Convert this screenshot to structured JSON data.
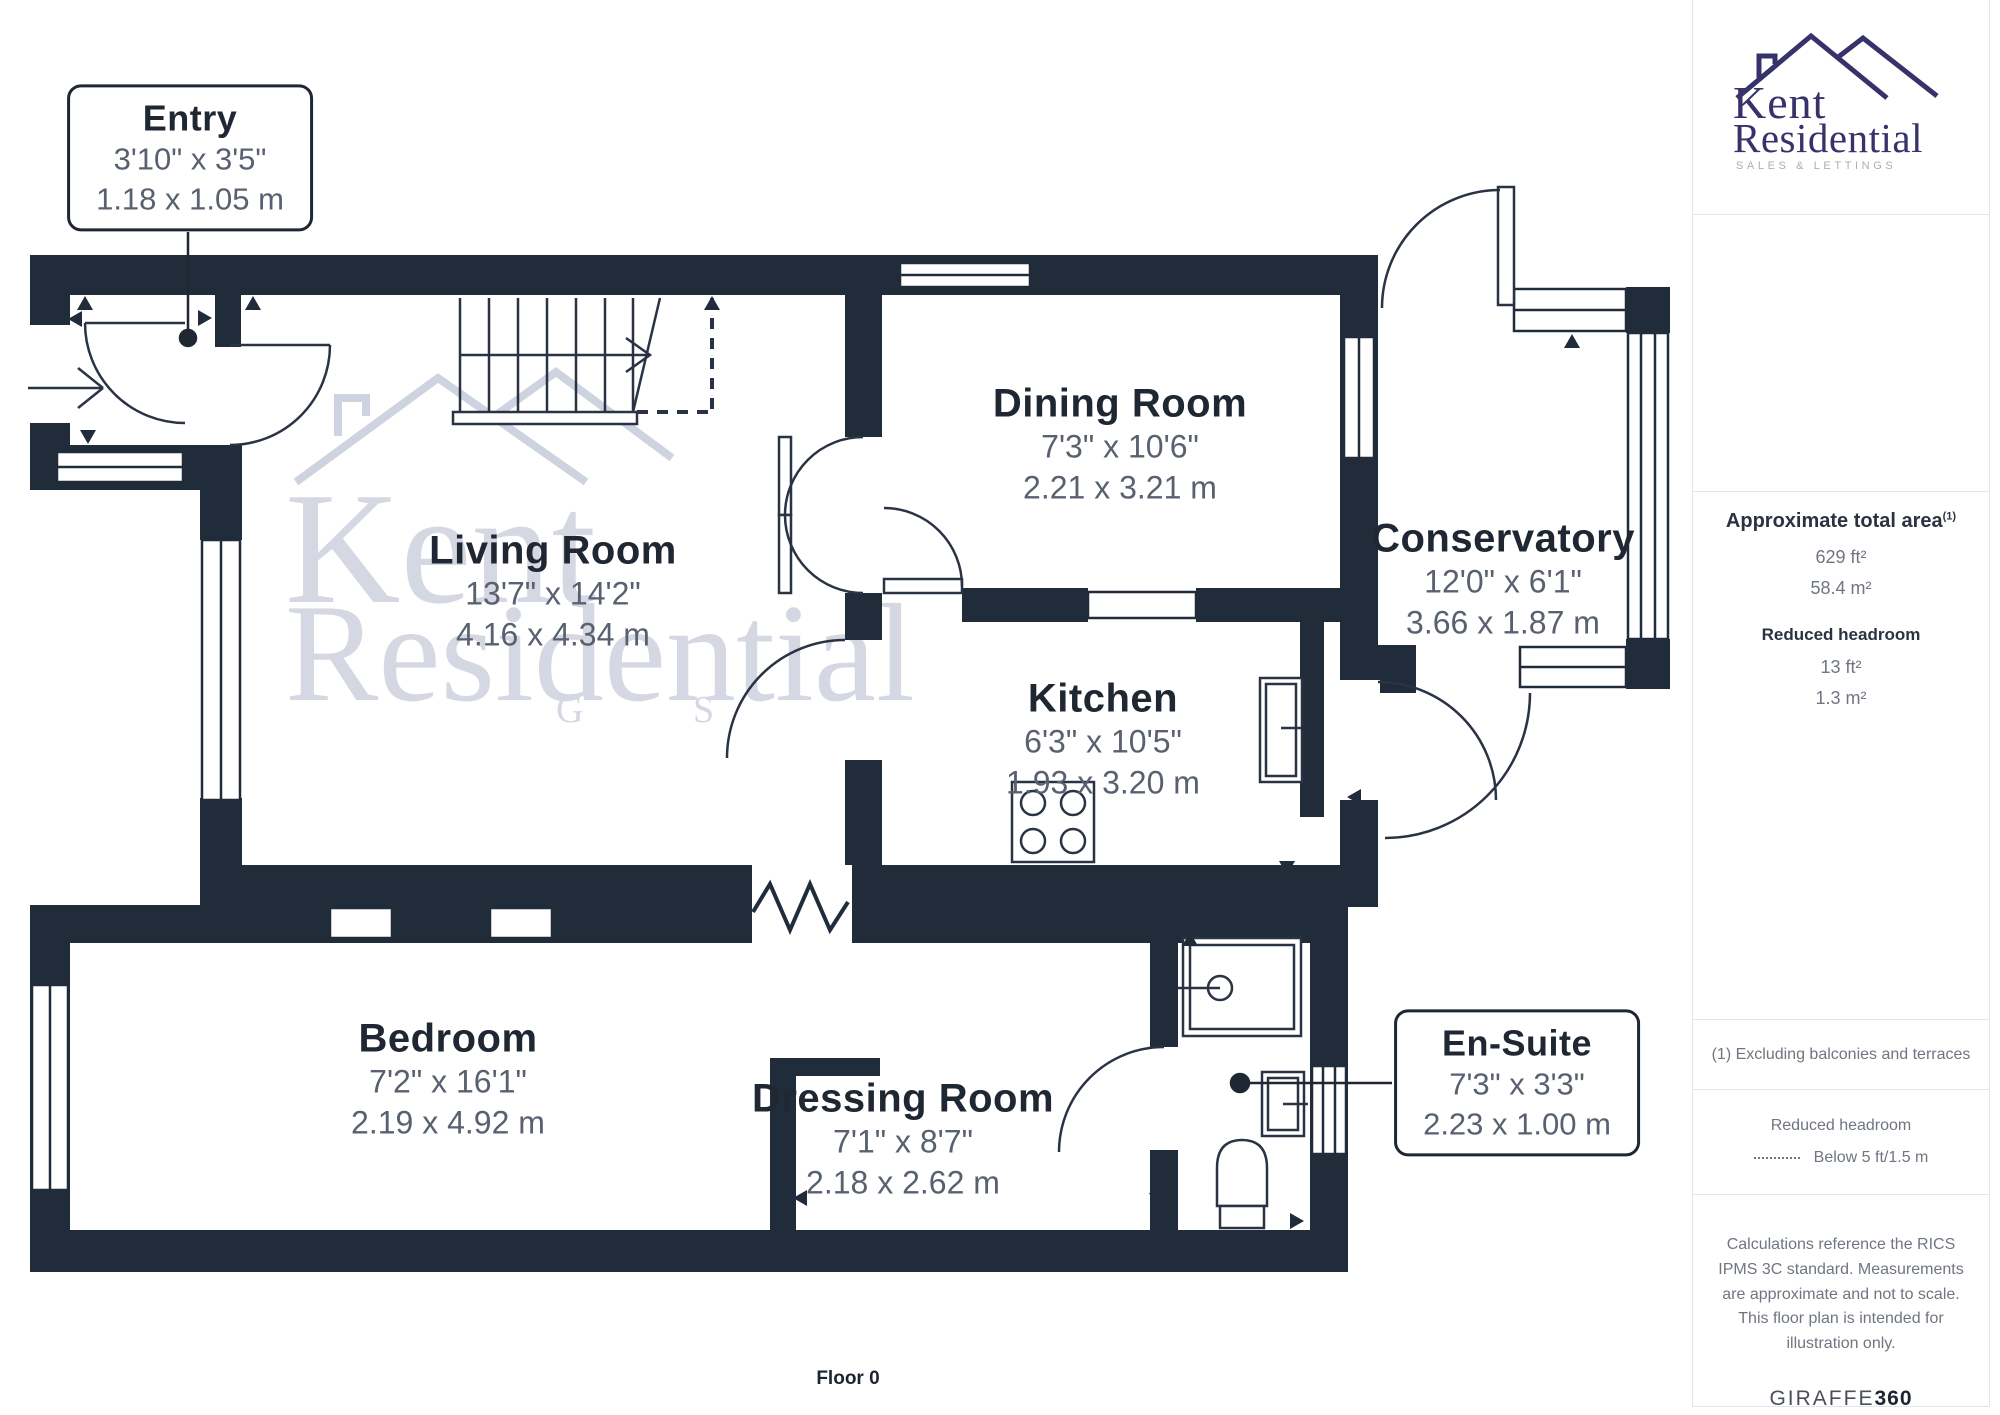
{
  "floorplan": {
    "floor_label": "Floor 0",
    "rooms": [
      {
        "name": "Entry",
        "dims_ft": "3'10\" x 3'5\"",
        "dims_m": "1.18 x 1.05 m"
      },
      {
        "name": "Living Room",
        "dims_ft": "13'7\" x 14'2\"",
        "dims_m": "4.16 x 4.34 m"
      },
      {
        "name": "Dining Room",
        "dims_ft": "7'3\" x 10'6\"",
        "dims_m": "2.21 x 3.21 m"
      },
      {
        "name": "Kitchen",
        "dims_ft": "6'3\" x 10'5\"",
        "dims_m": "1.93 x 3.20 m"
      },
      {
        "name": "Conservatory",
        "dims_ft": "12'0\" x 6'1\"",
        "dims_m": "3.66 x 1.87 m"
      },
      {
        "name": "Bedroom",
        "dims_ft": "7'2\" x 16'1\"",
        "dims_m": "2.19 x 4.92 m"
      },
      {
        "name": "Dressing Room",
        "dims_ft": "7'1\" x 8'7\"",
        "dims_m": "2.18 x 2.62 m"
      },
      {
        "name": "En-Suite",
        "dims_ft": "7'3\" x 3'3\"",
        "dims_m": "2.23 x 1.00 m"
      }
    ],
    "watermark": {
      "line1": "Kent",
      "line2": "Residential",
      "line3": "G S"
    }
  },
  "sidebar": {
    "logo": {
      "line1": "Kent",
      "line2": "Residential",
      "tagline": "SALES & LETTINGS"
    },
    "area": {
      "heading": "Approximate total area",
      "footnote_marker": "(1)",
      "value_ft": "629 ft²",
      "value_m": "58.4 m²",
      "reduced_heading": "Reduced headroom",
      "reduced_ft": "13 ft²",
      "reduced_m": "1.3 m²"
    },
    "footnote": "(1) Excluding balconies and terraces",
    "legend": {
      "title": "Reduced headroom",
      "item": "Below 5 ft/1.5 m"
    },
    "disclaimer": "Calculations reference the RICS IPMS 3C standard. Measurements are approximate and not to scale. This floor plan is intended for illustration only.",
    "brand": {
      "name": "GIRAFFE",
      "suffix": "360"
    }
  },
  "colors": {
    "wall": "#212c3b",
    "title_text": "#1f2733",
    "dims_text": "#596170",
    "logo_navy": "#37336a",
    "watermark": "#d5d8e3",
    "divider": "#e3e5ea"
  }
}
